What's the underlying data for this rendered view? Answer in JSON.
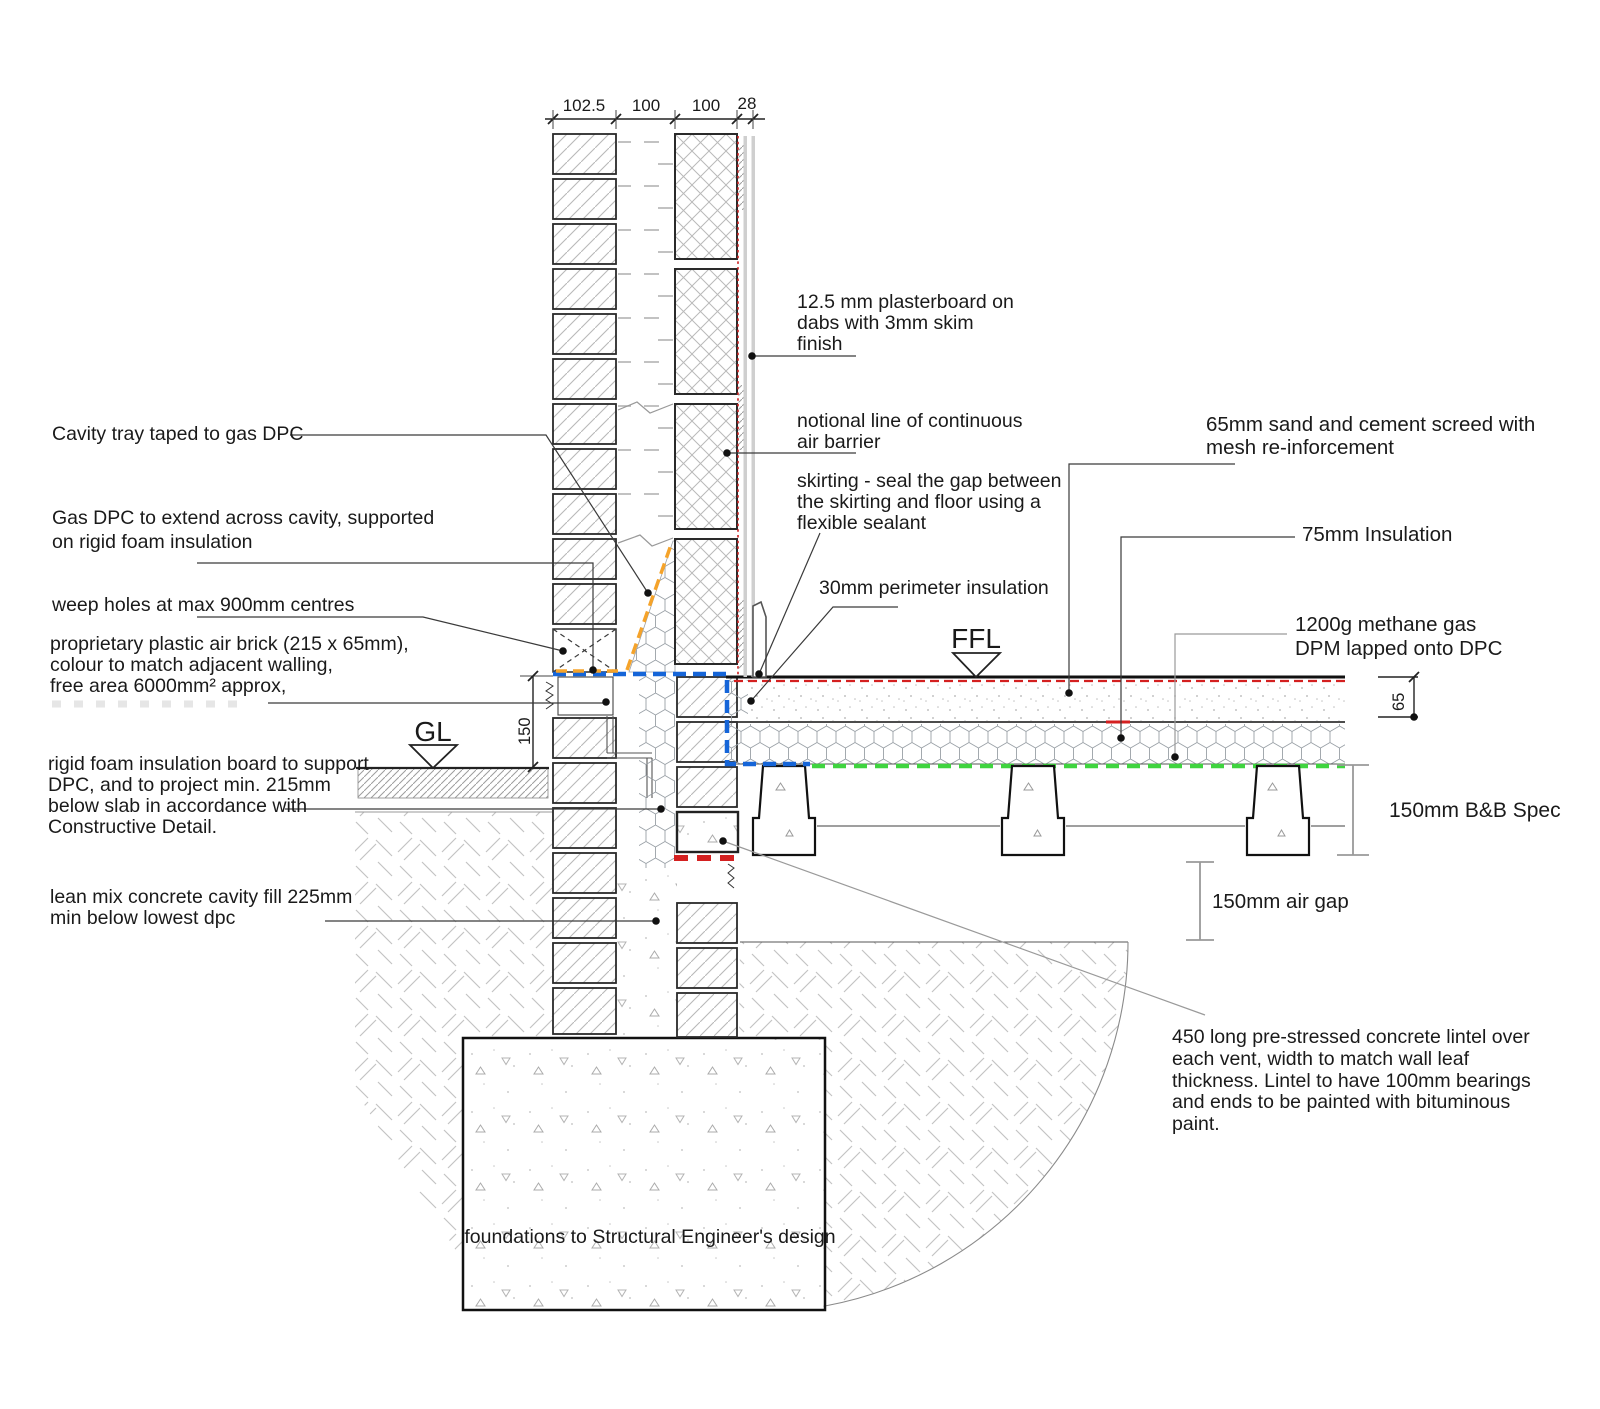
{
  "drawing": {
    "type": "construction-detail-section",
    "top_dimensions": [
      "102.5",
      "100",
      "100",
      "28"
    ],
    "markers": {
      "ffl": "FFL",
      "gl": "GL"
    },
    "left_labels": {
      "cavity_tray": [
        "Cavity tray taped to gas DPC"
      ],
      "gas_dpc": [
        "Gas DPC to extend across cavity, supported",
        "on rigid foam insulation"
      ],
      "weep_holes": [
        "weep holes at max 900mm centres"
      ],
      "air_brick": [
        "proprietary plastic air brick (215 x 65mm),",
        "colour to match adjacent walling,",
        "free area 6000mm² approx,"
      ],
      "rigid_foam": [
        "rigid foam insulation board to support",
        "DPC, and to project min. 215mm",
        "below slab in accordance with",
        "Constructive Detail."
      ],
      "lean_mix": [
        "lean mix concrete cavity fill 225mm",
        "min below lowest dpc"
      ]
    },
    "right_labels": {
      "plasterboard": [
        "12.5 mm plasterboard on",
        "dabs with 3mm skim",
        "finish"
      ],
      "air_barrier": [
        "notional line of continuous",
        "air barrier"
      ],
      "skirting": [
        "skirting - seal the gap between",
        "the skirting and floor using a",
        "flexible sealant"
      ],
      "perimeter_insulation": [
        "30mm perimeter insulation"
      ],
      "screed": [
        "65mm sand and cement screed with",
        "mesh re-inforcement"
      ],
      "insulation75": [
        "75mm Insulation"
      ],
      "dpm": [
        "1200g methane gas",
        "DPM lapped onto DPC"
      ],
      "lintel": [
        "450 long pre-stressed concrete lintel over",
        "each vent, width to match wall leaf",
        "thickness. Lintel to have 100mm bearings",
        "and ends to be painted with bituminous",
        "paint."
      ]
    },
    "dimensions": {
      "d150": "150",
      "d65": "65",
      "bb_spec": "150mm B&B Spec",
      "air_gap": "150mm air gap"
    },
    "foundation_label": "foundations to Structural Engineer's design",
    "colors": {
      "dpc_blue": "#1565d8",
      "tray_orange": "#f5a32a",
      "dpm_red": "#d42020",
      "gas_green": "#3fd43f",
      "barrier_red": "#cc2020"
    }
  }
}
